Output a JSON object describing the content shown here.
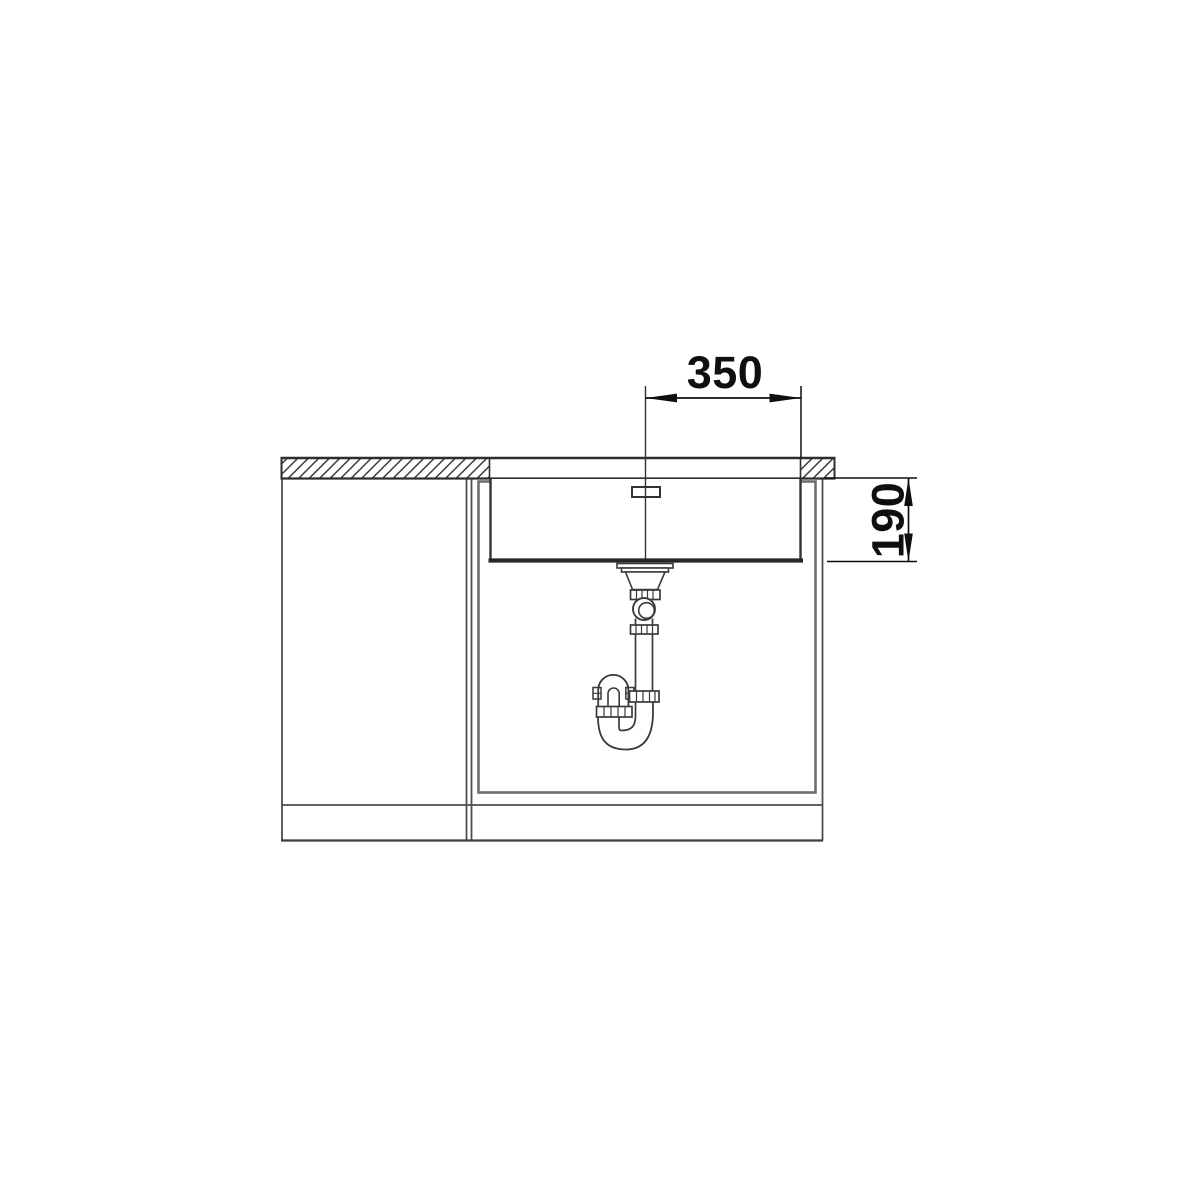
{
  "drawing": {
    "kind": "sink-installation-cross-section",
    "dimensions": {
      "center_to_edge_mm": "350",
      "bowl_depth_mm": "190"
    },
    "colors": {
      "background": "#ffffff",
      "outline": "#3f3f3f",
      "strong_outline": "#2a2a2a",
      "panel": "#6e6e6e",
      "dimension": "#0f0f0f"
    }
  }
}
